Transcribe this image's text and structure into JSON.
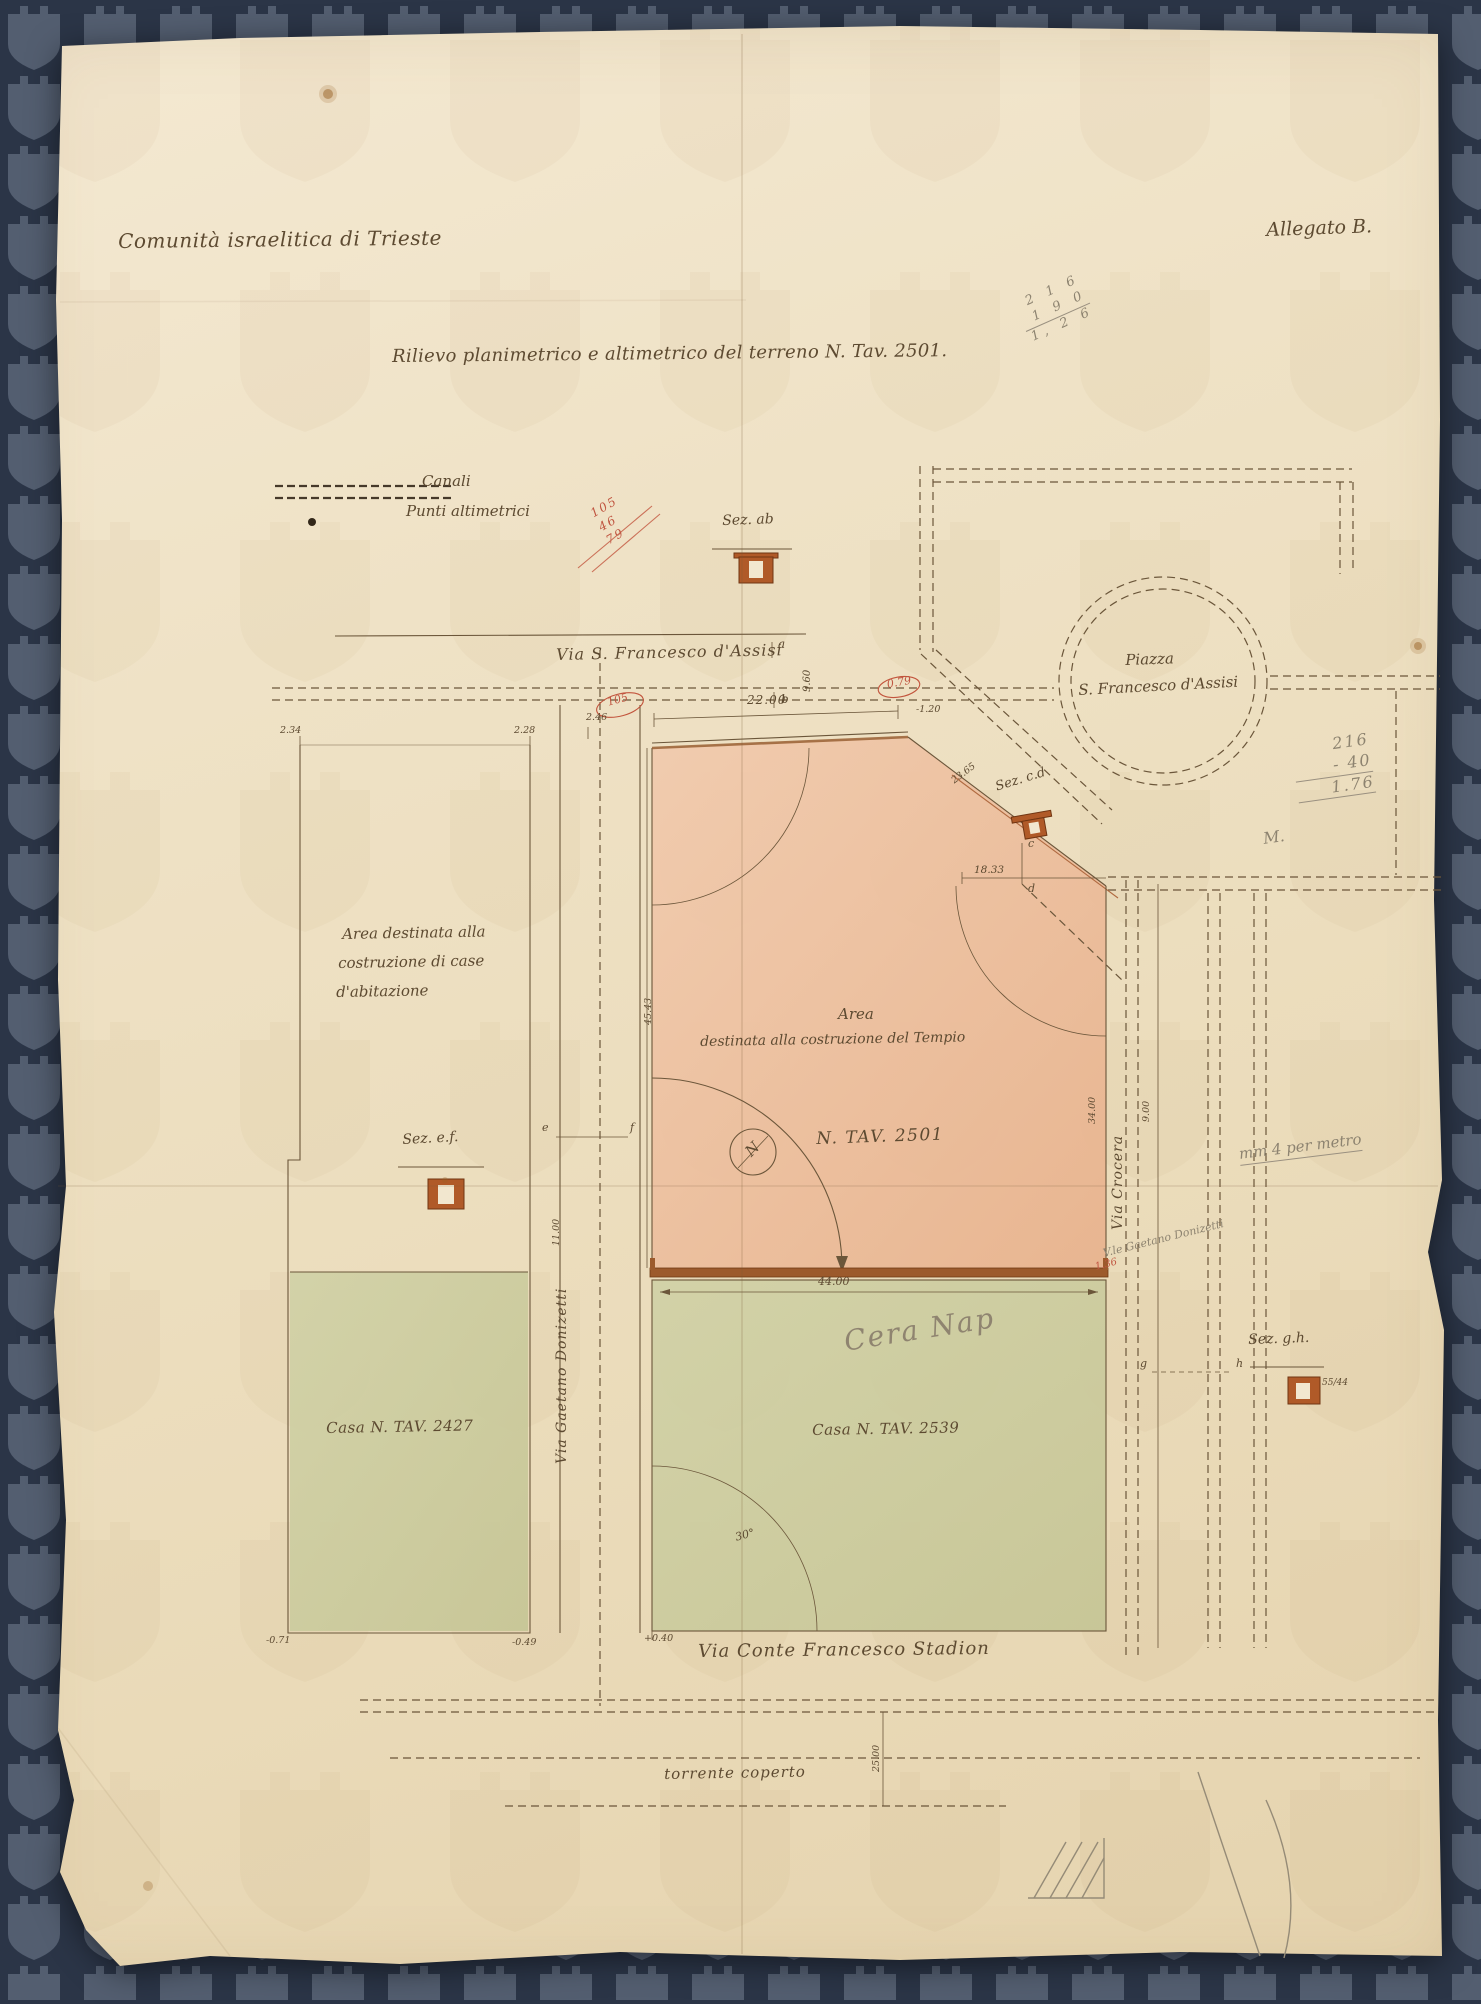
{
  "header": {
    "org": "Comunità israelitica di Trieste",
    "allegato": "Allegato B.",
    "title": "Rilievo planimetrico e altimetrico del terreno N. Tav. 2501."
  },
  "legend": {
    "canali": "Canali",
    "punti": "Punti altimetrici"
  },
  "streets": {
    "assisi": "Via S. Francesco d'Assisi",
    "piazza1": "Piazza",
    "piazza2": "S. Francesco d'Assisi",
    "donizetti": "Via Gaetano Donizetti",
    "crocera": "Via Crocera",
    "stadion": "Via Conte Francesco Stadion",
    "torrente": "torrente coperto"
  },
  "areas": {
    "case1": "Area destinata alla",
    "case2": "costruzione di case",
    "case3": "d'abitazione",
    "tempio1": "Area",
    "tempio2": "destinata alla costruzione del Tempio",
    "tempio_tav": "N. TAV. 2501",
    "casa2427": "Casa N. TAV. 2427",
    "casa2539": "Casa N. TAV. 2539"
  },
  "sections": {
    "ab": "Sez. ab",
    "cd": "Sez. c.d",
    "ef": "Sez. e.f.",
    "gh": "Sez. g.h.",
    "gh_fraction": "55/44"
  },
  "points": {
    "a": "a",
    "b": "b",
    "c": "c",
    "d": "d",
    "e": "e",
    "f": "f",
    "g": "g",
    "h": "h",
    "north": "N"
  },
  "dims": {
    "top_left_1": "2.34",
    "top_left_2": "2.28",
    "assisi_height": "9.60",
    "tempio_width": "22.00",
    "small_246": "2.46",
    "red_105": "105",
    "red_079": "0.79",
    "neg_120": "-1.20",
    "cd_diag": "23.65",
    "notch": "18.33",
    "tempio_left": "45.43",
    "tempio_right": "34.00",
    "crocera_w": "9.00",
    "donizetti_w": "11.00",
    "wall": "44.00",
    "angle": "30°",
    "bl_1": "-0.71",
    "bl_2": "-0.49",
    "bl_3": "+0.40",
    "stadion_w": "25.00",
    "red_136": "1.36"
  },
  "pencil": {
    "calc_top": [
      "2 1 6",
      "1 9 0",
      "1, 2 6"
    ],
    "calc_right": [
      "216",
      "- 40",
      "1.76"
    ],
    "calc_right_prefix": "M.",
    "red_note": [
      "105",
      "46",
      "79"
    ],
    "scale_note": "mm 4 per metro",
    "cera": "Cera Nap",
    "vle": "V.le Gaetano Donizetti"
  }
}
